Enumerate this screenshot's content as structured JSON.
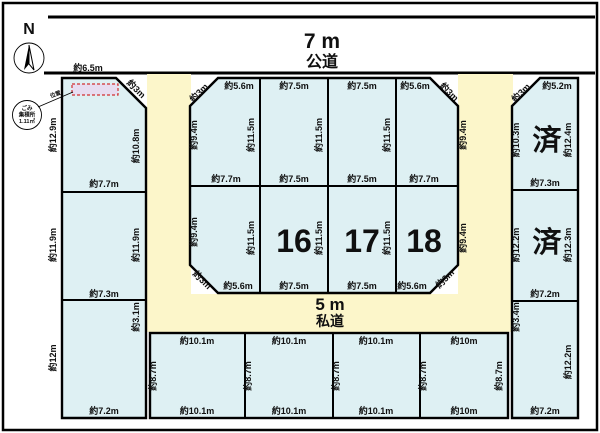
{
  "compass": {
    "north_label": "N"
  },
  "roads": {
    "public": {
      "size": "7 m",
      "name": "公道"
    },
    "private": {
      "size": "5 m",
      "name": "私道"
    }
  },
  "garbage_station": {
    "line1": "ごみ",
    "line2": "集積所",
    "line3": "1.11㎡",
    "pointer_label": "位置"
  },
  "plots": {
    "left_top": {
      "top": "約6.5m",
      "corner": "約3m",
      "left": "約12.9m",
      "right": "約10.8m",
      "bottom": "約7.7m"
    },
    "left_mid": {
      "left": "約11.9m",
      "right": "約11.9m",
      "bottom": "約7.3m"
    },
    "left_bottom": {
      "left": "約12m",
      "right_top": "約3.1m",
      "bottom": "約7.2m"
    },
    "inner_t1": {
      "corner": "約3m",
      "top": "約5.6m",
      "left": "約9.4m",
      "bottom": "約7.7m",
      "divider_right": "約11.5m"
    },
    "inner_t2": {
      "top": "約7.5m",
      "bottom": "約7.5m",
      "divider_right": "約11.5m"
    },
    "inner_t3": {
      "top": "約7.5m",
      "bottom": "約7.5m",
      "divider_right": "約11.5m"
    },
    "inner_t4": {
      "top": "約5.6m",
      "corner": "約3m",
      "bottom": "約7.7m",
      "right": "約9.4m"
    },
    "inner_b1": {
      "left": "約9.4m",
      "corner": "約3m",
      "bottom": "約5.6m",
      "divider_right": "約11.5m"
    },
    "inner_b2": {
      "number": "16",
      "bottom": "約7.5m",
      "divider_right": "約11.5m"
    },
    "inner_b3": {
      "number": "17",
      "bottom": "約7.5m",
      "divider_right": "約11.5m"
    },
    "inner_b4": {
      "number": "18",
      "bottom": "約5.6m",
      "corner": "約3m",
      "right": "約9.4m"
    },
    "right_top": {
      "corner": "約3m",
      "top": "約5.2m",
      "left": "約10.3m",
      "right": "約12.4m",
      "bottom": "約7.3m",
      "status": "済"
    },
    "right_mid": {
      "left": "約12.2m",
      "right": "約12.3m",
      "bottom": "約7.2m",
      "status": "済"
    },
    "right_bottom": {
      "left_top": "約3.4m",
      "right": "約12.2m",
      "bottom": "約7.2m"
    },
    "bottom_1": {
      "top": "約10.1m",
      "left": "約8.7m",
      "bottom": "約10.1m"
    },
    "bottom_2": {
      "top": "約10.1m",
      "left": "約8.7m",
      "bottom": "約10.1m"
    },
    "bottom_3": {
      "top": "約10.1m",
      "left": "約8.7m",
      "bottom": "約10.1m"
    },
    "bottom_4": {
      "top": "約10m",
      "left": "約8.7m",
      "right": "約8.7m",
      "bottom": "約10m"
    }
  },
  "colors": {
    "plot_fill": "#def0f3",
    "road_fill": "#fcf6ca",
    "line": "#000000",
    "garbage_fill": "#e7ddf1",
    "garbage_border": "#d23030"
  }
}
